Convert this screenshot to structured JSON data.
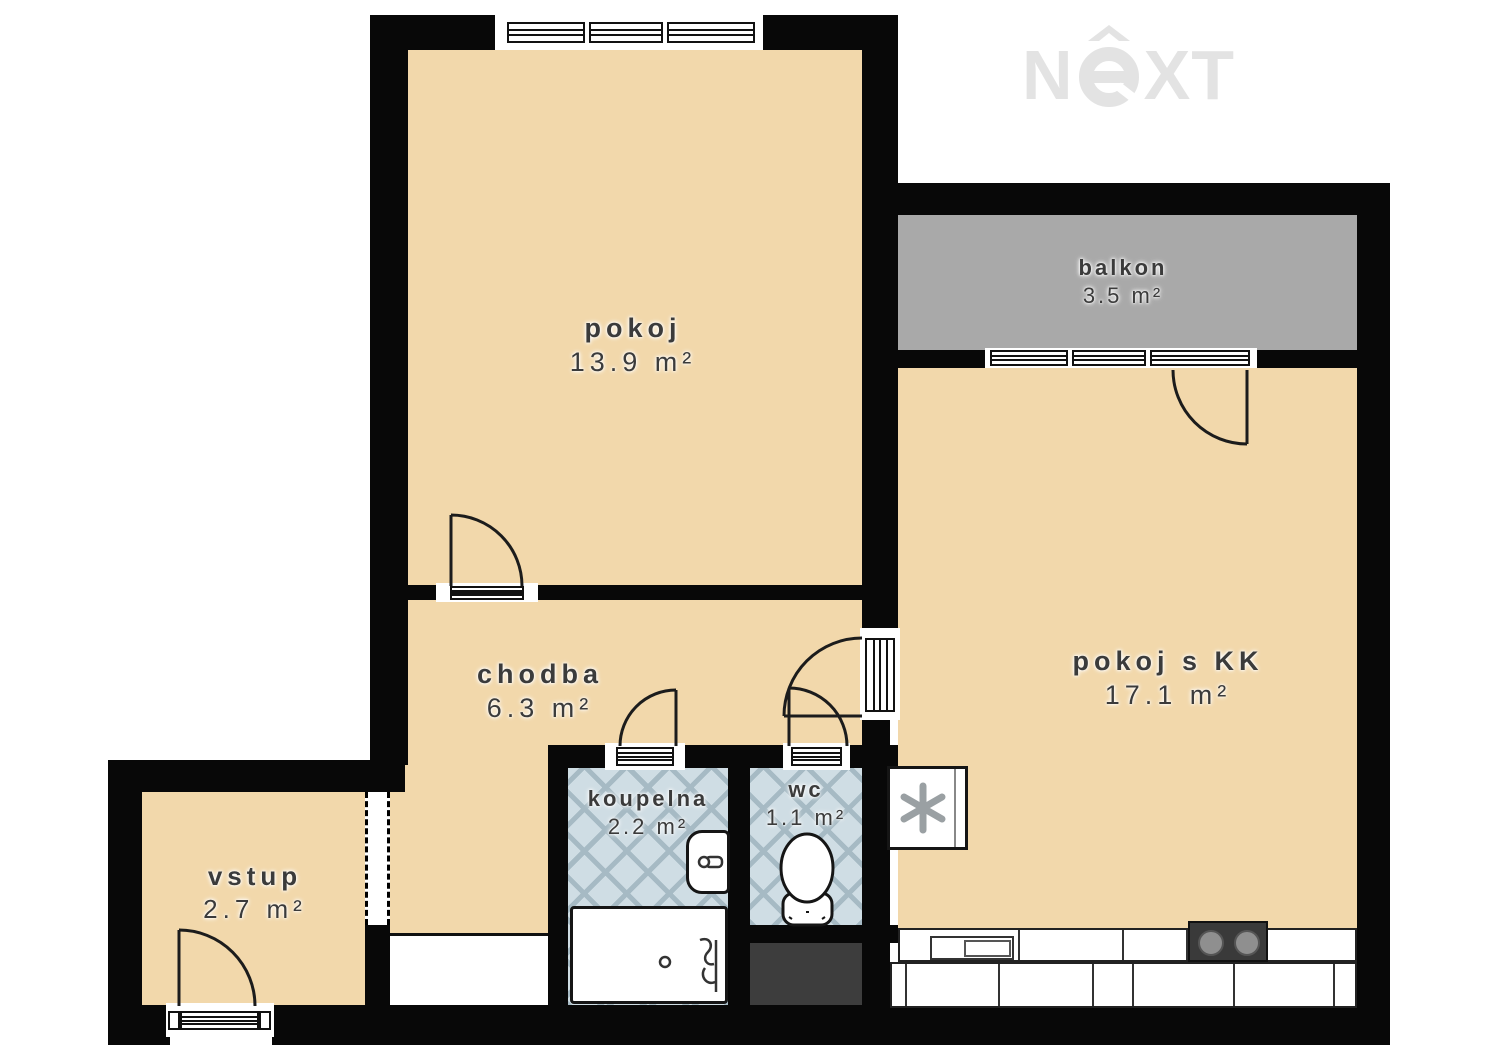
{
  "logo": {
    "n": "N",
    "xt": "XT",
    "alt": "NeXT"
  },
  "rooms": [
    {
      "label": "pokoj",
      "area": "13.9 m²"
    },
    {
      "label": "balkon",
      "area": "3.5 m²"
    },
    {
      "label": "pokoj s KK",
      "area": "17.1 m²"
    },
    {
      "label": "chodba",
      "area": "6.3 m²"
    },
    {
      "label": "koupelna",
      "area": "2.2 m²"
    },
    {
      "label": "wc",
      "area": "1.1 m²"
    },
    {
      "label": "vstup",
      "area": "2.7 m²"
    }
  ],
  "palette": {
    "room_fill": "#f2d8ab",
    "balcony_fill": "#a9a9a9",
    "tile_fill": "#cfdde4",
    "tile_line": "#a6bac4",
    "wall": "#080808",
    "shaft_fill": "#3d3d3d",
    "label_text": "#3b3b3b",
    "logo": "#e3e3e3"
  },
  "fixtures": [
    "bathtub",
    "washbasin",
    "toilet",
    "fridge",
    "kitchen-counter",
    "kitchen-sink",
    "cooktop",
    "ventilation-shaft"
  ]
}
